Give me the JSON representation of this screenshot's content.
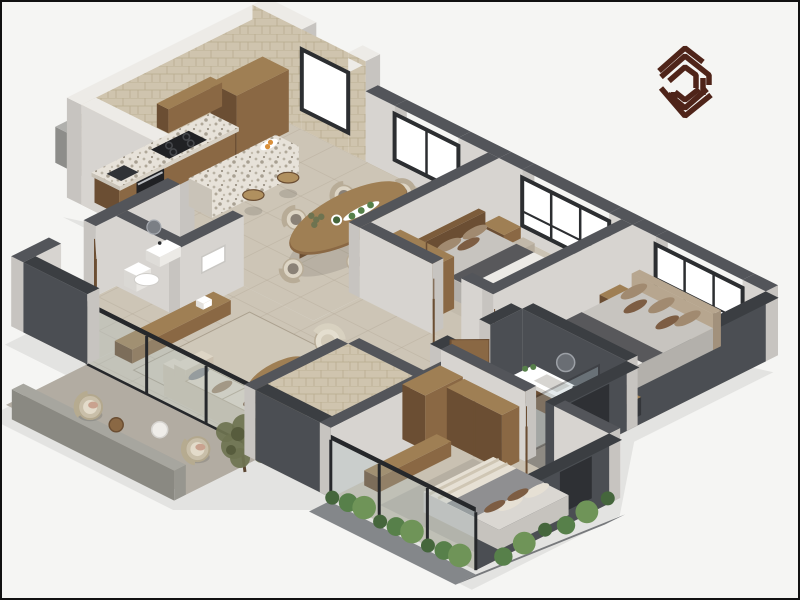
{
  "meta": {
    "title": "3D isometric apartment floor plan render",
    "view": "isometric cutaway, walls cut at door height",
    "background_note": "plain off-white backdrop with thin black frame, brand logomark top-right"
  },
  "logo": {
    "name": "brand-logomark",
    "shape": "hexagonal nested chevrons forming N monogram",
    "color": "#4f2419"
  },
  "windows": [
    {
      "room": "kitchen",
      "panes": 1
    },
    {
      "room": "dining",
      "panes": 2
    },
    {
      "room": "bedroom-1",
      "panes": 3
    },
    {
      "room": "bedroom-2",
      "panes": 3
    }
  ],
  "rooms": [
    {
      "id": "kitchen",
      "label": "Kitchen",
      "furniture": [
        "tall-cabinets",
        "upper-cabinets",
        "base-cabinets",
        "terrazzo-counter",
        "gas-cooktop",
        "built-in-oven",
        "sink",
        "kitchen-island",
        "bar-stool-1",
        "bar-stool-2",
        "breakfast-tray"
      ]
    },
    {
      "id": "dining",
      "label": "Dining area",
      "furniture": [
        "oval-wood-table",
        "dining-chair-1",
        "dining-chair-2",
        "dining-chair-3",
        "dining-chair-4",
        "dining-chair-5",
        "dining-chair-6",
        "serving-tray",
        "greens-bowl"
      ]
    },
    {
      "id": "living",
      "label": "Living room",
      "furniture": [
        "area-rug",
        "media-console",
        "wall-art",
        "boucle-armchair",
        "oval-coffee-table",
        "sofa",
        "throw-pillows"
      ]
    },
    {
      "id": "entry",
      "label": "Entry",
      "furniture": [
        "open-wood-door"
      ]
    },
    {
      "id": "powder-room",
      "label": "Guest WC",
      "furniture": [
        "wall-hung-basin",
        "toilet",
        "round-mirror"
      ]
    },
    {
      "id": "bedroom-1",
      "label": "Bedroom 1",
      "furniture": [
        "double-bed",
        "wood-headboard",
        "nightstand",
        "pouf",
        "dark-throw",
        "wardrobe",
        "foot-bench",
        "rug"
      ]
    },
    {
      "id": "bedroom-2",
      "label": "Bedroom 2",
      "furniture": [
        "king-bed",
        "upholstered-headboard",
        "nightstand",
        "pouf",
        "long-dresser",
        "foot-bench",
        "rug"
      ]
    },
    {
      "id": "ensuite-bathroom",
      "label": "Ensuite bathroom",
      "furniture": [
        "wood-vanity",
        "white-basin",
        "round-mirror",
        "plant",
        "walk-in-shower",
        "dark-feature-walls"
      ]
    },
    {
      "id": "bathroom-2",
      "label": "Bathroom",
      "furniture": [
        "wood-vanity",
        "white-basin",
        "toilet",
        "glass-shower",
        "beige-tile-walls"
      ]
    },
    {
      "id": "bedroom-3",
      "label": "Bedroom 3",
      "furniture": [
        "bed",
        "striped-throw",
        "bench-dresser",
        "wardrobe-a",
        "wardrobe-b",
        "rug",
        "glazed-wall"
      ]
    },
    {
      "id": "balcony",
      "label": "Balcony",
      "furniture": [
        "rattan-chair-1",
        "rattan-chair-2",
        "wood-side-table",
        "white-side-table",
        "potted-tree",
        "planter-shrubs",
        "parapet"
      ]
    }
  ],
  "palette": {
    "bg": "#f5f5f3",
    "frame": "#111111",
    "wallTop": "#53555a",
    "wallTopDark": "#3b3e42",
    "wallWhiteTop": "#edebe7",
    "wallLight": "#d7d4d0",
    "wallShade": "#c7c4c0",
    "wallDark": "#4b4e53",
    "wallDarkShade": "#3f4246",
    "tileWall": "#cfc4ae",
    "tileWallLine": "#b9ad8f",
    "floorOpen": "#cdc5b6",
    "floorLine": "#b7ad9c",
    "floorBed1": "#cbc3b4",
    "floorBed2": "#c7bfb0",
    "floorBed3": "#c9c1b2",
    "floorBath": "#b5aea3",
    "floorEnsuite": "#a19c94",
    "floorBalcony": "#b2aca2",
    "floorTerrace": "#b8b4ac",
    "rug1": "#c3bbac",
    "rug2": "#bdb5a6",
    "rug3": "#b6afa2",
    "rugLiving": "#cfc8b9",
    "rugLine": "#aba18f",
    "woodTop": "#9f7f54",
    "woodSE": "#8a6844",
    "woodSW": "#6b4e33",
    "woodDarkTop": "#7c5c3b",
    "woodDarkSE": "#6b4e33",
    "woodDarkSW": "#57402a",
    "woodLight": "#b0905f",
    "terrTop": "#e7e2d9",
    "terrSE": "#d8d2c7",
    "terrSW": "#c9c3b8",
    "matTop": "#c7c4bf",
    "matSide": "#b3b0ab",
    "matTop3": "#dad7d2",
    "matSide3": "#c6c3be",
    "white": "#ffffff",
    "offWhite": "#eceae6",
    "throwDark": "#58585b",
    "blanketGray": "#8f8f91",
    "pillowBrown": "#7d5d43",
    "pillowTaupe": "#a18a70",
    "pillowCream": "#e6e0d4",
    "headboard2": "#b7a68f",
    "headboard2Side": "#a2917c",
    "cream": "#ddd5c5",
    "creamShade": "#cabfae",
    "creamDark": "#b8ac97",
    "seatCushion": "#8a8176",
    "rattan": "#c9bfa9",
    "cushion": "#e3dbca",
    "blush": "#c9a28f",
    "applianceDark": "#202124",
    "steel": "#b9bcc0",
    "black": "#26282b",
    "glass": "#a9bdc3",
    "frameDark": "#2c2e31",
    "greenDark": "#45663c",
    "green": "#57804a",
    "greenLight": "#6f9458",
    "olive": "#6e7350",
    "oliveDark": "#575c3d",
    "trunk": "#5b4632",
    "planterBox": "#84878a",
    "logoBrown": "#4f2419",
    "orange": "#d98f3a",
    "shadow": "rgba(0,0,0,0.07)"
  }
}
